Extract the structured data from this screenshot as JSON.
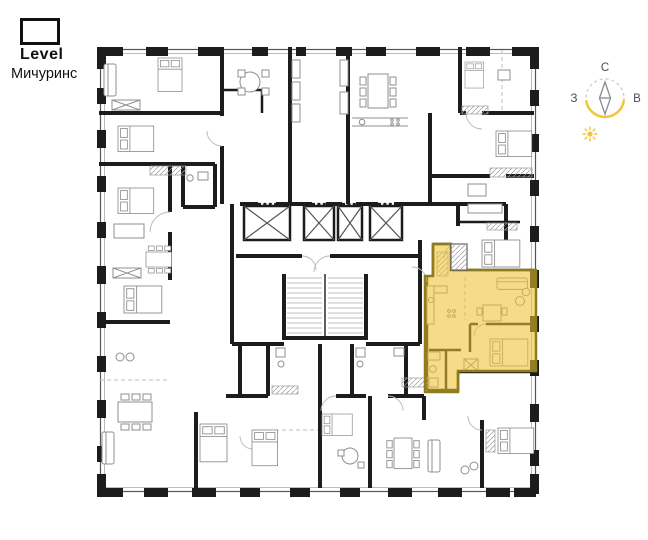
{
  "logo": {
    "brand": "Level",
    "project": "Мичуринс"
  },
  "compass": {
    "north": "С",
    "west": "З",
    "east": "В"
  },
  "colors": {
    "wall": "#1C1C1C",
    "detail": "#8F8F8F",
    "highlight_fill": "#EFC233",
    "highlight_stroke": "#8F7C1D",
    "accent": "#F2C53D"
  }
}
